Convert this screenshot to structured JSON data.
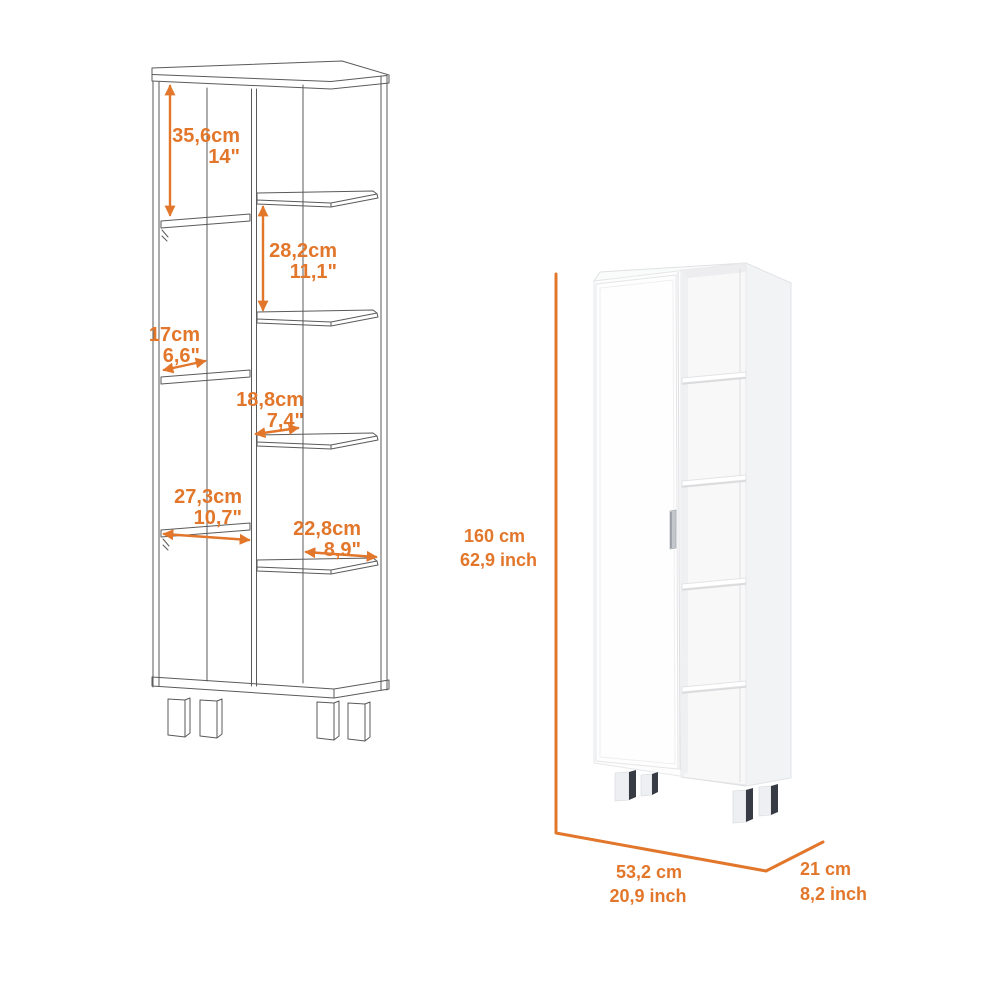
{
  "product_diagram": {
    "accent_color": "#E2772C",
    "line_color": "#5a5a5a",
    "wireframe_view": {
      "name": "corner linen cabinet line drawing",
      "dims": [
        {
          "cm": "35,6cm",
          "inch": "14\""
        },
        {
          "cm": "28,2cm",
          "inch": "11,1\""
        },
        {
          "cm": "17cm",
          "inch": "6,6\""
        },
        {
          "cm": "18,8cm",
          "inch": "7,4\""
        },
        {
          "cm": "27,3cm",
          "inch": "10,7\""
        },
        {
          "cm": "22,8cm",
          "inch": "8,9\""
        }
      ]
    },
    "render_view": {
      "name": "white cabinet 3d render",
      "height": {
        "cm": "160 cm",
        "inch": "62,9 inch"
      },
      "width": {
        "cm": "53,2 cm",
        "inch": "20,9 inch"
      },
      "depth": {
        "cm": "21 cm",
        "inch": "8,2 inch"
      }
    }
  }
}
